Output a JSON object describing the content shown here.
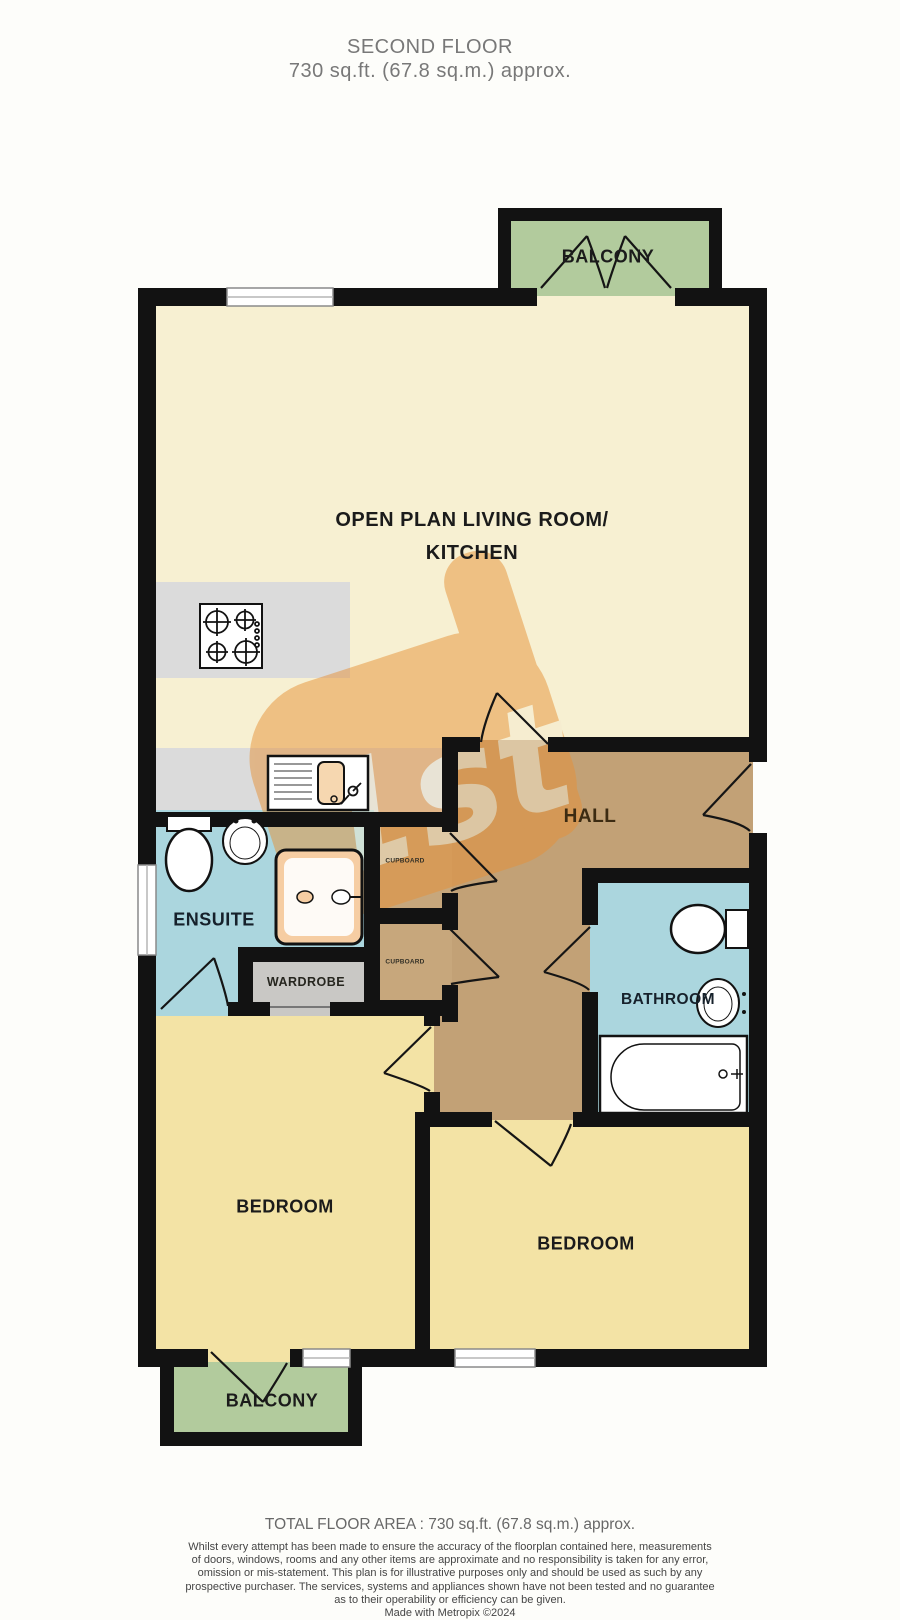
{
  "header": {
    "title": "SECOND FLOOR",
    "subtitle": "730 sq.ft. (67.8 sq.m.) approx."
  },
  "rooms": {
    "balcony_top": "BALCONY",
    "living_line1": "OPEN PLAN LIVING ROOM/",
    "living_line2": "KITCHEN",
    "hall": "HALL",
    "cupboard_top": "CUPBOARD",
    "cupboard_bottom": "CUPBOARD",
    "ensuite": "ENSUITE",
    "wardrobe": "WARDROBE",
    "bathroom": "BATHROOM",
    "bedroom_left": "BEDROOM",
    "bedroom_right": "BEDROOM",
    "balcony_bottom": "BALCONY"
  },
  "footer": {
    "total_area": "TOTAL FLOOR AREA : 730 sq.ft. (67.8 sq.m.) approx.",
    "disclaimer_lines": [
      "Whilst every attempt has been made to ensure the accuracy of the floorplan contained here, measurements",
      "of doors, windows, rooms and any other items are approximate and no responsibility is taken for any error,",
      "omission or mis-statement. This plan is for illustrative purposes only and should be used as such by any",
      "prospective purchaser. The services, systems and appliances shown have not been tested and no guarantee",
      "as to their operability or efficiency can be given."
    ],
    "credit": "Made with Metropix ©2024"
  },
  "icons": {
    "hob": "hob-icon",
    "kitchen_sink": "kitchen-sink-icon",
    "toilet_ensuite": "toilet-icon",
    "basin_ensuite": "basin-icon",
    "shower": "shower-icon",
    "toilet_bathroom": "toilet-icon",
    "basin_bathroom": "basin-icon",
    "bathtub": "bathtub-icon",
    "watermark": "agency-watermark"
  },
  "colors": {
    "wall": "#121212",
    "living_floor": "#f7f0d2",
    "bedroom_floor": "#f3e3a5",
    "balcony_floor": "#b2cb9d",
    "wet_room_floor": "#abd6de",
    "hall_floor": "#c2a176",
    "counter_gray": "#dbdbdb",
    "wardrobe_gray": "#c9c8c5",
    "shower_tray": "#f6cda3",
    "watermark_orange": "#e69137",
    "header_text": "#787878",
    "disclaimer_text": "#454545"
  }
}
